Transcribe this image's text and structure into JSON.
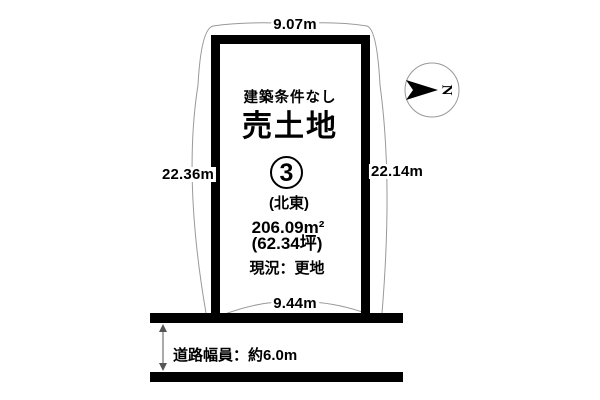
{
  "plan": {
    "dimensions": {
      "top": "9.07m",
      "left": "22.36m",
      "right": "22.14m",
      "bottom": "9.44m"
    },
    "labels": {
      "condition": "建築条件なし",
      "title": "売土地",
      "lot_number": "3",
      "orientation": "(北東)",
      "area_sqm": "206.09m²",
      "area_tsubo": "(62.34坪)",
      "status": "現況：更地",
      "road_width": "道路幅員：約6.0m"
    },
    "compass": {
      "letter": "N"
    }
  },
  "colors": {
    "ink": "#000000",
    "leader": "#999999",
    "background": "#ffffff"
  }
}
